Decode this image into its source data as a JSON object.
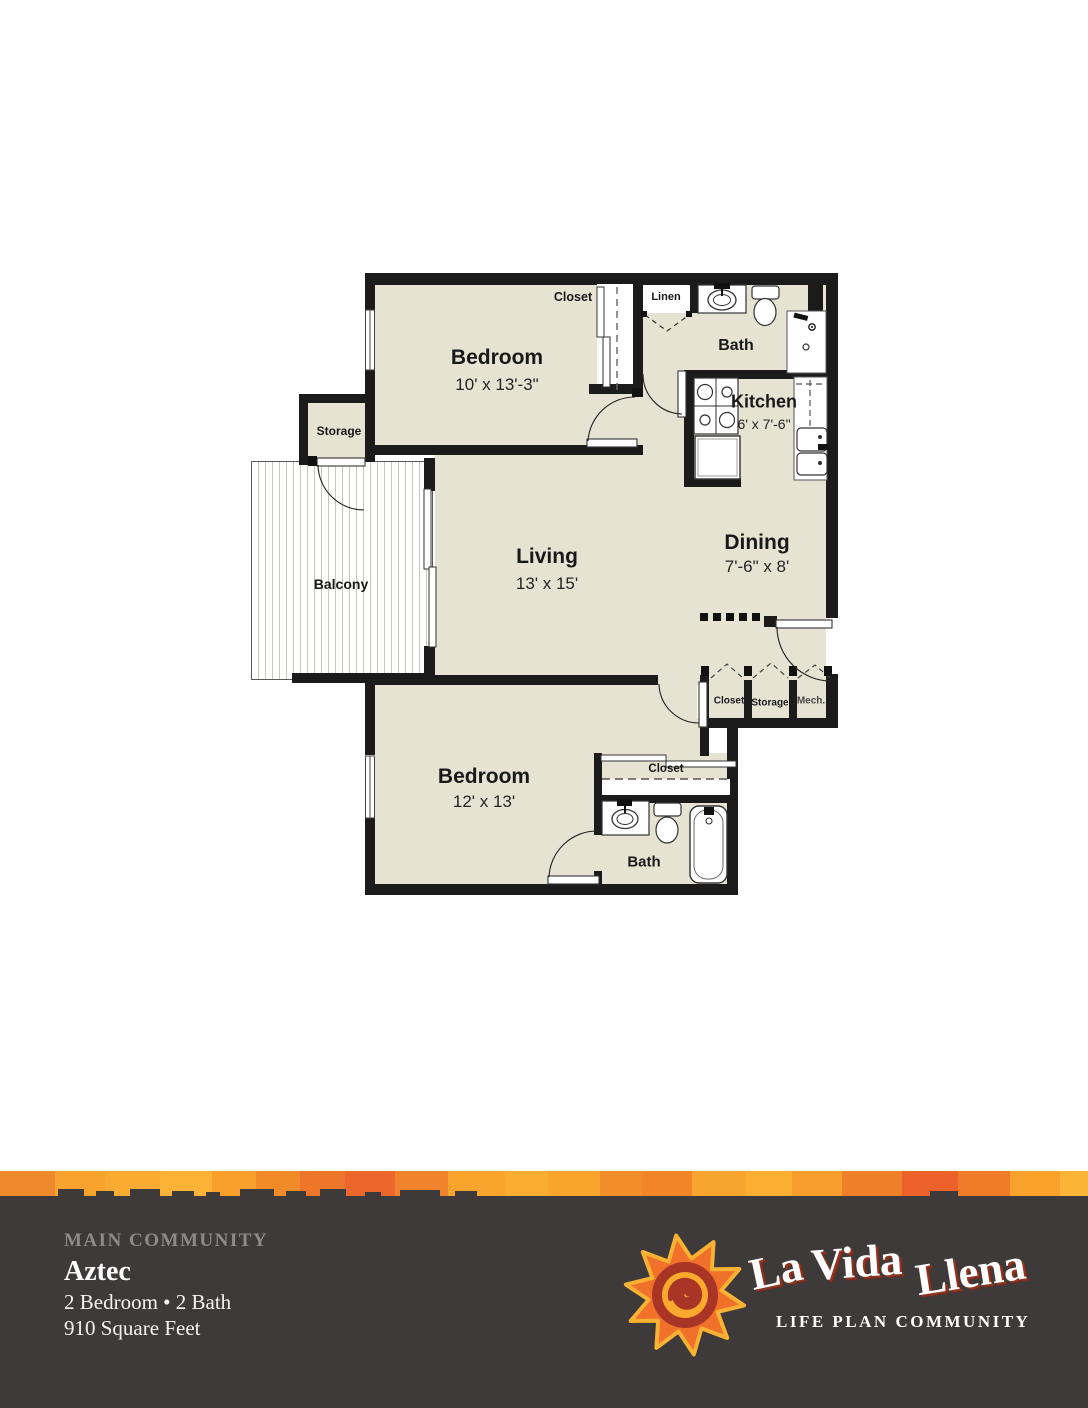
{
  "plan": {
    "rooms": [
      {
        "name": "Bedroom",
        "dims": "10' x 13'-3\""
      },
      {
        "name": "Living",
        "dims": "13' x 15'"
      },
      {
        "name": "Dining",
        "dims": "7'-6\" x 8'"
      },
      {
        "name": "Kitchen",
        "dims": "6' x 7'-6\""
      },
      {
        "name": "Bedroom",
        "dims": "12' x 13'"
      },
      {
        "name": "Bath"
      },
      {
        "name": "Bath"
      },
      {
        "name": "Balcony"
      },
      {
        "name": "Storage"
      },
      {
        "name": "Closet"
      },
      {
        "name": "Linen"
      },
      {
        "name": "Closet"
      },
      {
        "name": "Closet"
      },
      {
        "name": "Storage"
      },
      {
        "name": "Mech."
      }
    ]
  },
  "footer": {
    "community_label": "MAIN COMMUNITY",
    "unit_name": "Aztec",
    "configuration": "2 Bedroom • 2 Bath",
    "area": "910 Square Feet"
  },
  "logo": {
    "word1": "La",
    "word2": "Vida",
    "word3": "Llena",
    "tagline": "LIFE PLAN COMMUNITY"
  },
  "colors": {
    "floor": "#e7e3d3",
    "wall": "#1b1b1b",
    "footer_bg": "#3e3a39",
    "muted_text": "#8d8a8a",
    "sun_orange": "#f1702a",
    "sun_gold": "#f9b233",
    "sun_red": "#a93527"
  }
}
